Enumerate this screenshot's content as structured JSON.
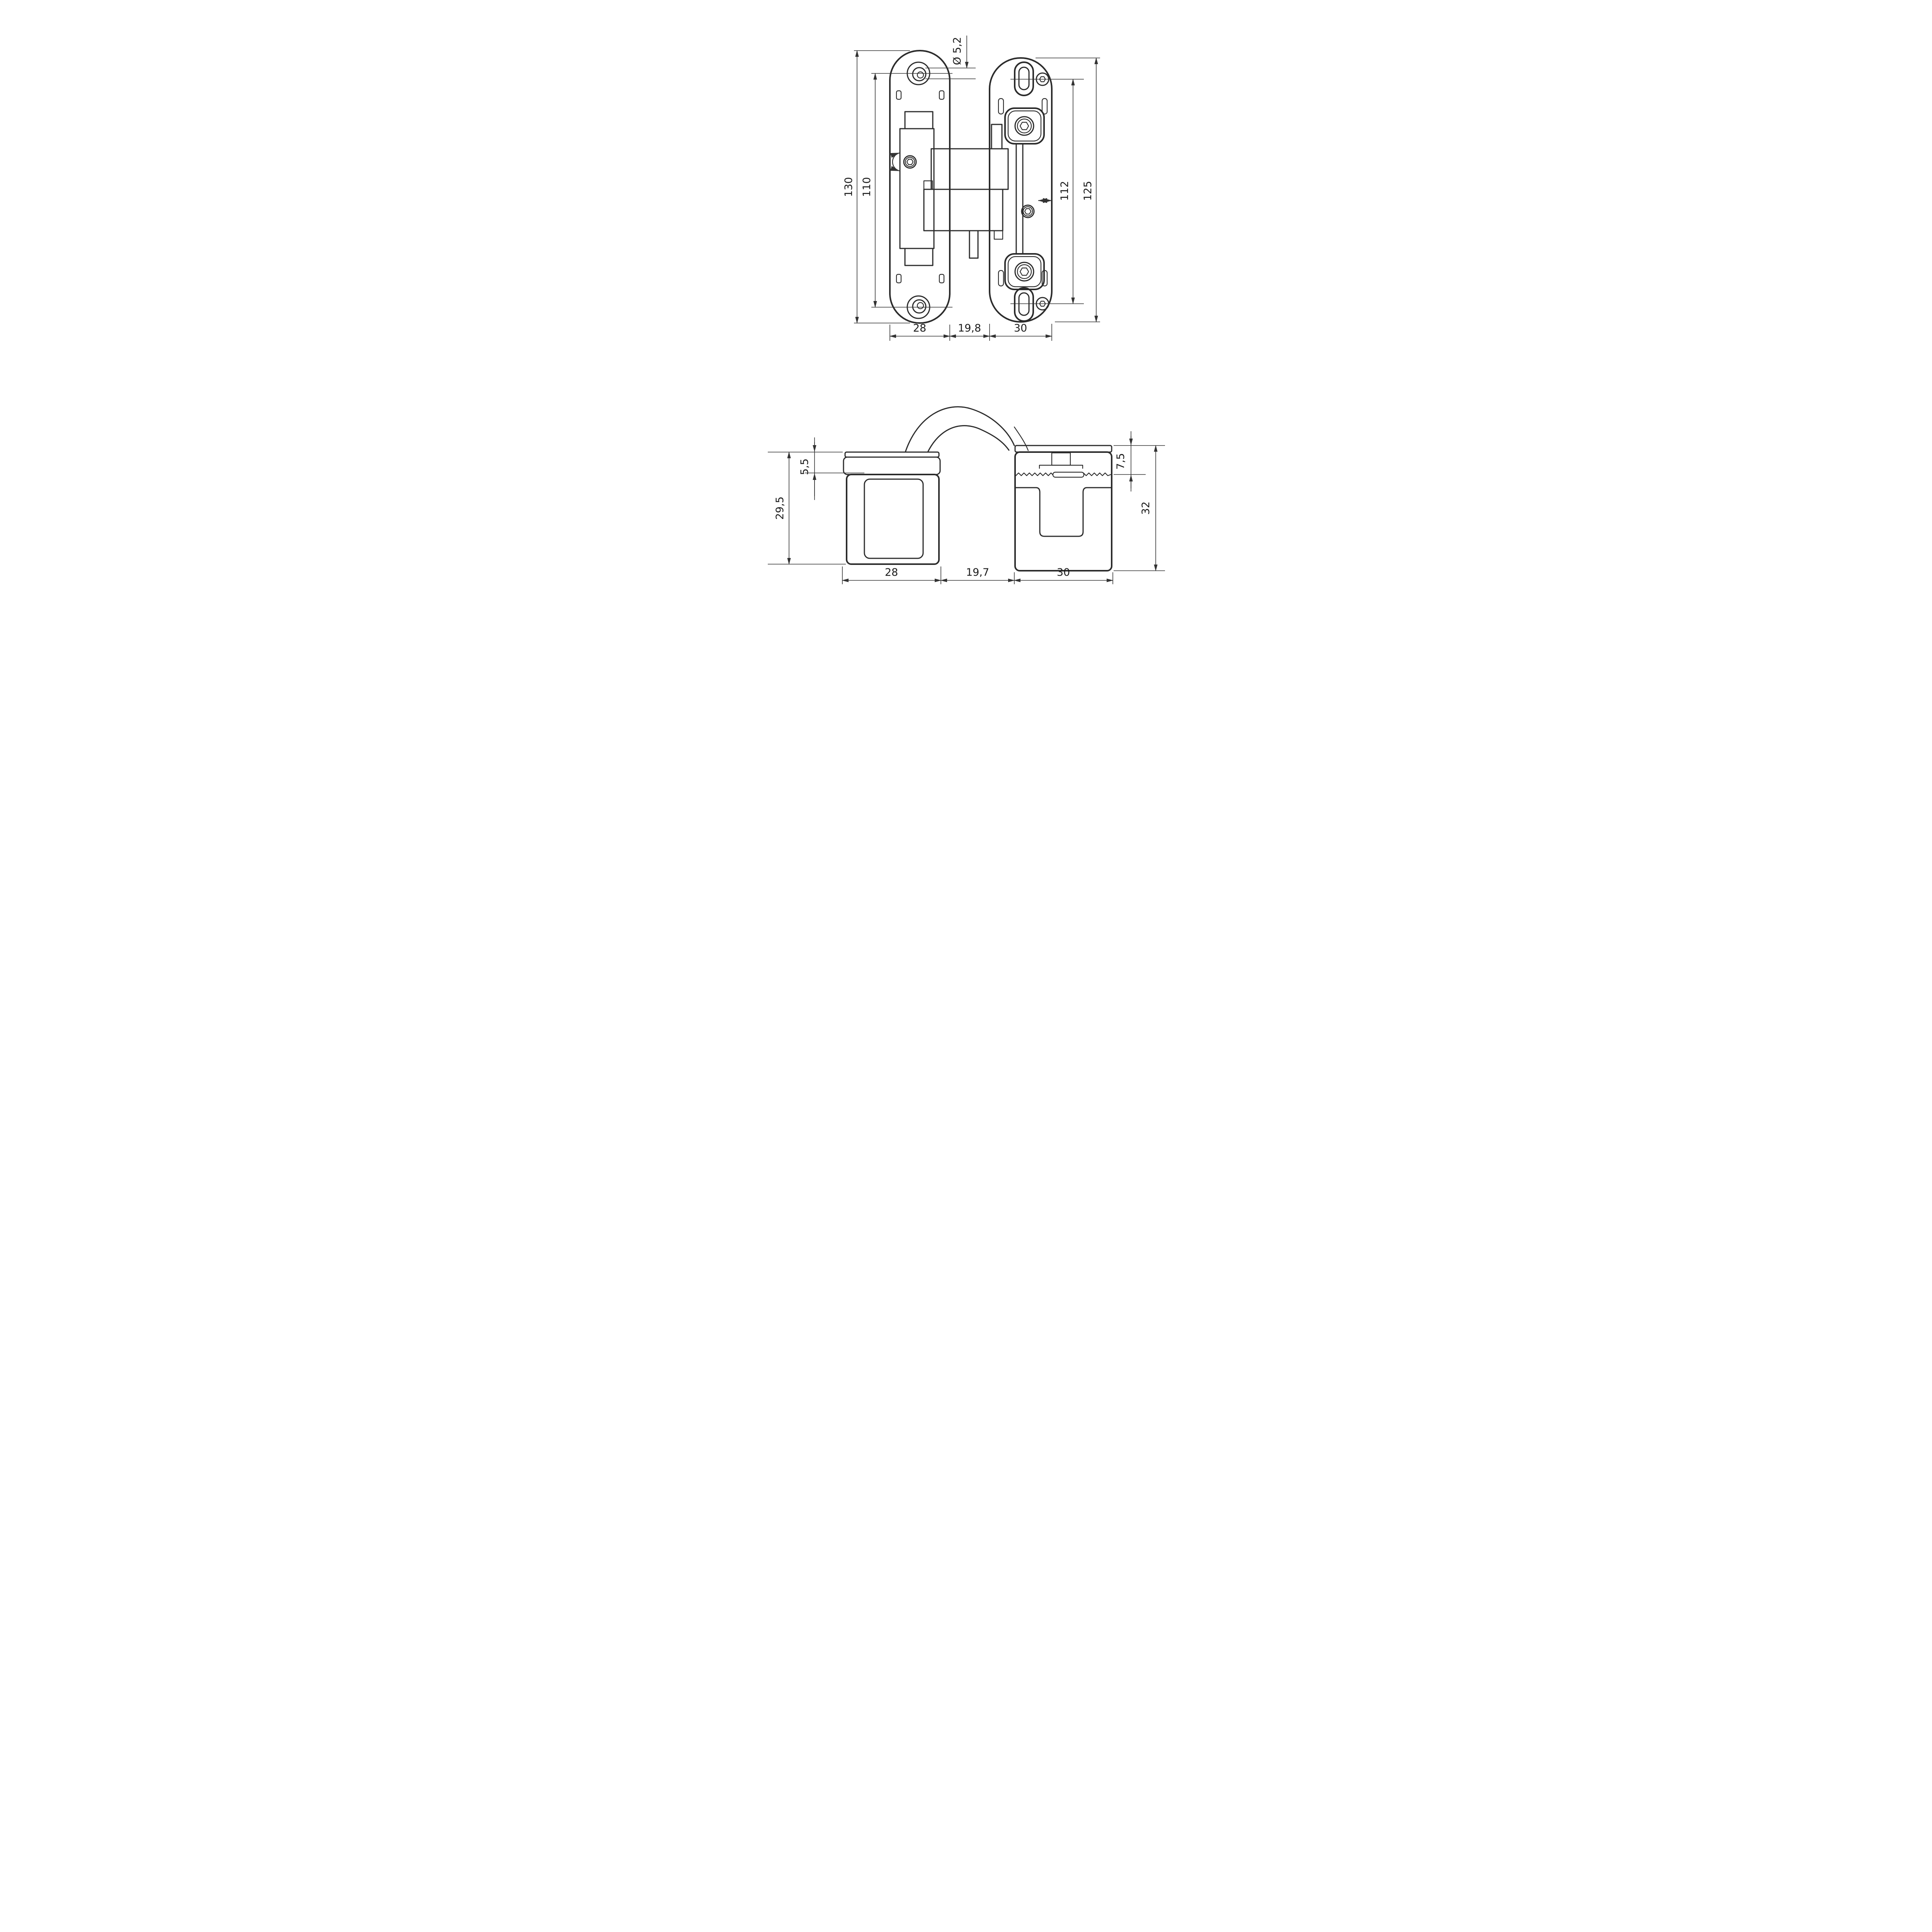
{
  "front_view": {
    "hole_diameter": "Ø 5,2",
    "plate_height_left": "130",
    "hole_spacing_left": "110",
    "hole_spacing_right": "112",
    "plate_height_right": "125",
    "plate_width_left": "28",
    "gap_width": "19,8",
    "plate_width_right": "30"
  },
  "side_view": {
    "body_height_left": "29,5",
    "flange_depth_left": "5,5",
    "cup_depth_right": "7,5",
    "body_height_right": "32",
    "body_width_left": "28",
    "gap_width": "19,7",
    "body_width_right": "30"
  }
}
